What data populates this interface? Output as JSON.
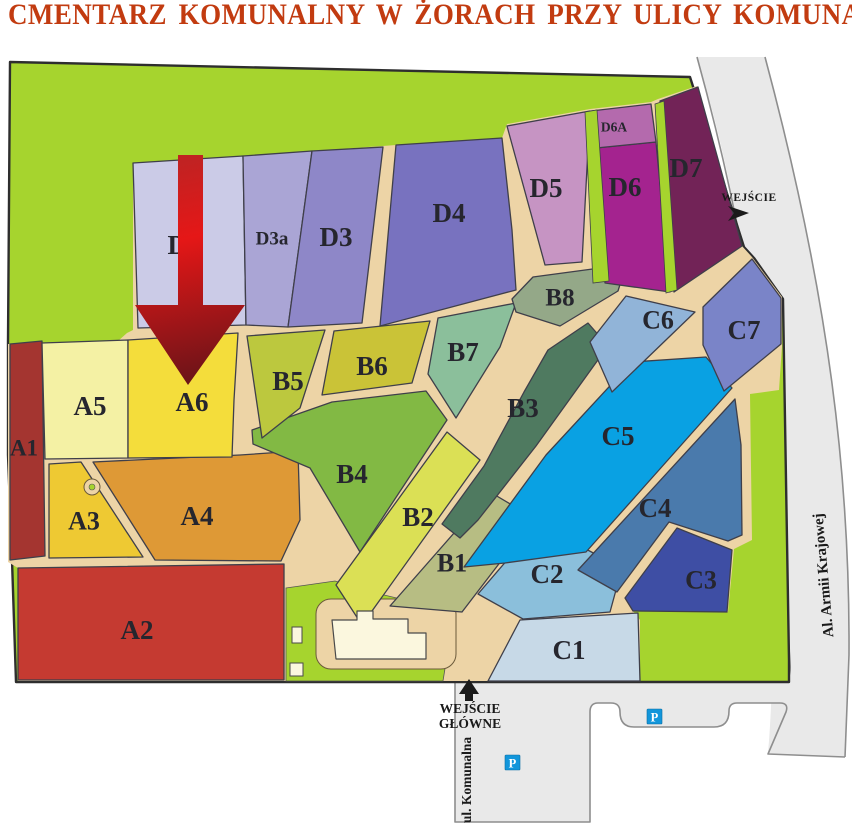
{
  "title": {
    "text": "CMENTARZ KOMUNALNY W ŻORACH PRZY ULICY KOMUNALNEJ",
    "color": "#c23b10"
  },
  "map": {
    "sections": [
      {
        "id": "A1",
        "label": "A1",
        "color": "#a43530"
      },
      {
        "id": "A2",
        "label": "A2",
        "color": "#c53a31"
      },
      {
        "id": "A3",
        "label": "A3",
        "color": "#eec933"
      },
      {
        "id": "A4",
        "label": "A4",
        "color": "#de9936"
      },
      {
        "id": "A5",
        "label": "A5",
        "color": "#f4f1a4"
      },
      {
        "id": "A6",
        "label": "A6",
        "color": "#f4dd3b"
      },
      {
        "id": "B1",
        "label": "B1",
        "color": "#b7bd83"
      },
      {
        "id": "B2",
        "label": "B2",
        "color": "#dbe055"
      },
      {
        "id": "B3",
        "label": "B3",
        "color": "#4f7a60"
      },
      {
        "id": "B4",
        "label": "B4",
        "color": "#82b944"
      },
      {
        "id": "B5",
        "label": "B5",
        "color": "#bcc83e"
      },
      {
        "id": "B6",
        "label": "B6",
        "color": "#cac337"
      },
      {
        "id": "B7",
        "label": "B7",
        "color": "#8bbf9b"
      },
      {
        "id": "B8",
        "label": "B8",
        "color": "#94a888"
      },
      {
        "id": "C1",
        "label": "C1",
        "color": "#c7d9e7"
      },
      {
        "id": "C2",
        "label": "C2",
        "color": "#8bbfdb"
      },
      {
        "id": "C3",
        "label": "C3",
        "color": "#3e4ea4"
      },
      {
        "id": "C4",
        "label": "C4",
        "color": "#4a7aac"
      },
      {
        "id": "C5",
        "label": "C5",
        "color": "#09a1e3"
      },
      {
        "id": "C6",
        "label": "C6",
        "color": "#91b4d8"
      },
      {
        "id": "C7",
        "label": "C7",
        "color": "#7a84c8"
      },
      {
        "id": "D2",
        "label": "D2",
        "color": "#cbcbe7"
      },
      {
        "id": "D3a",
        "label": "D3a",
        "color": "#aaa5d5"
      },
      {
        "id": "D3",
        "label": "D3",
        "color": "#8e87c8"
      },
      {
        "id": "D4",
        "label": "D4",
        "color": "#7872bf"
      },
      {
        "id": "D5",
        "label": "D5",
        "color": "#c694c3"
      },
      {
        "id": "D6",
        "label": "D6",
        "color": "#a4238f"
      },
      {
        "id": "D6A",
        "label": "D6A",
        "color": "#b46aad"
      },
      {
        "id": "D7",
        "label": "D7",
        "color": "#722357"
      }
    ],
    "labels": {
      "entrance_side": "WEJŚCIE",
      "entrance_main_line1": "WEJŚCIE",
      "entrance_main_line2": "GŁÓWNE",
      "street_bottom": "ul. Komunalna",
      "street_right": "Al. Armii Krajowej",
      "parking": "P"
    },
    "colors": {
      "lawn": "#a6d42e",
      "path": "#edd4a6",
      "road": "#e9e9e9",
      "road_edge": "#8e8e8e",
      "building": "#fbf7de",
      "section_outline": "#3f3f4a",
      "label": "#26262e",
      "parking_bg": "#1296db",
      "arrow_top": "#c12222",
      "arrow_mid": "#e51717",
      "arrow_tip": "#6d1418"
    }
  }
}
